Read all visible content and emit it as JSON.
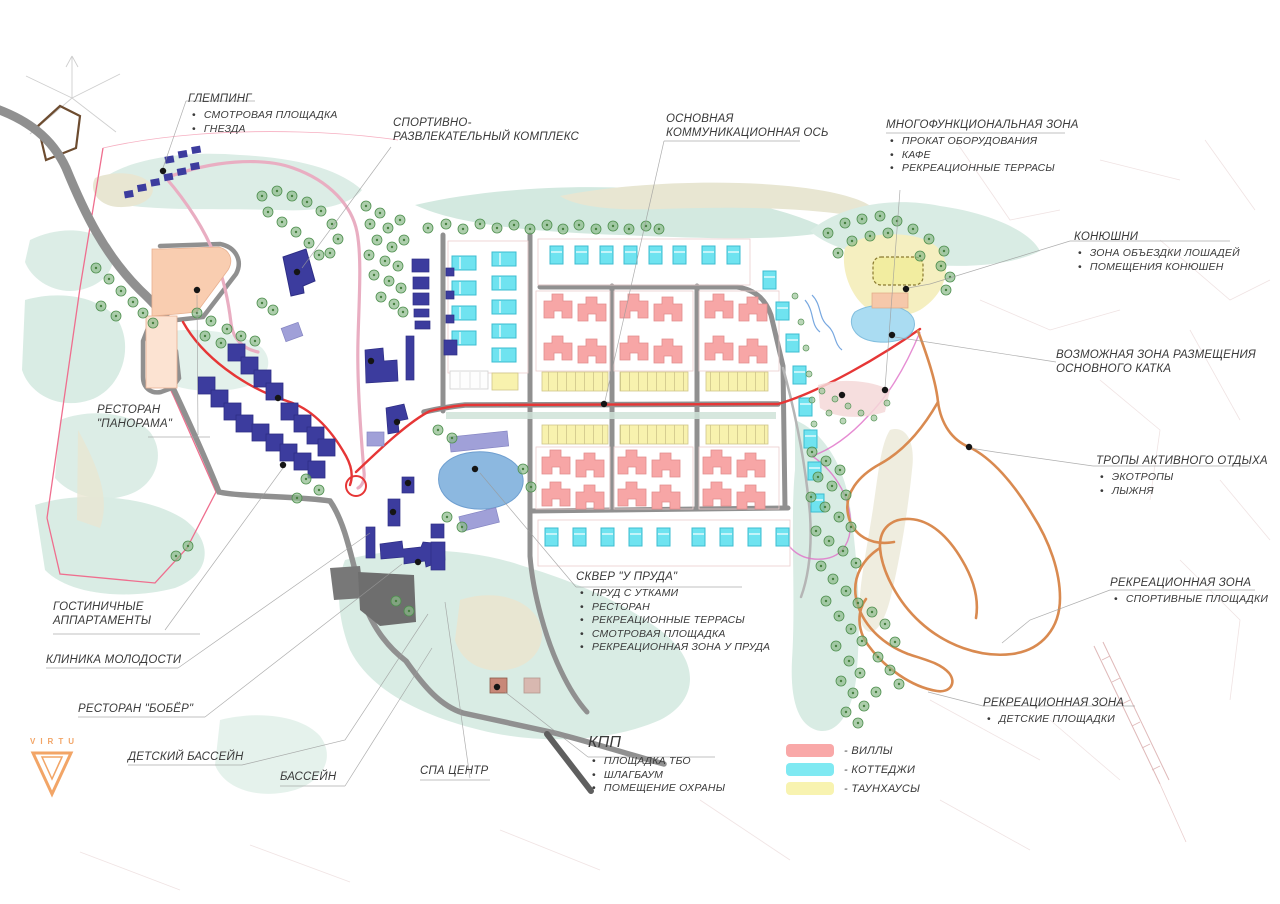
{
  "callouts": {
    "glamping": {
      "title": "ГЛЕМПИНГ",
      "items": [
        "СМОТРОВАЯ ПЛОЩАДКА",
        "ГНЕЗДА"
      ]
    },
    "sports": {
      "title": "СПОРТИВНО-РАЗВЛЕКАТЕЛЬНЫЙ КОМПЛЕКС"
    },
    "axis": {
      "title": "ОСНОВНАЯ КОММУНИКАЦИОННАЯ ОСЬ"
    },
    "multizone": {
      "title": "МНОГОФУНКЦИОНАЛЬНАЯ ЗОНА",
      "items": [
        "ПРОКАТ ОБОРУДОВАНИЯ",
        "КАФЕ",
        "РЕКРЕАЦИОННЫЕ ТЕРРАСЫ"
      ]
    },
    "stables": {
      "title": "КОНЮШНИ",
      "items": [
        "ЗОНА ОБЪЕЗДКИ ЛОШАДЕЙ",
        "ПОМЕЩЕНИЯ КОНЮШЕН"
      ]
    },
    "rink": {
      "title": "ВОЗМОЖНАЯ ЗОНА РАЗМЕЩЕНИЯ ОСНОВНОГО КАТКА"
    },
    "trails": {
      "title": "ТРОПЫ АКТИВНОГО ОТДЫХА",
      "items": [
        "ЭКОТРОПЫ",
        "ЛЫЖНЯ"
      ]
    },
    "rec_sport": {
      "title": "РЕКРЕАЦИОННАЯ ЗОНА",
      "items": [
        "СПОРТИВНЫЕ ПЛОЩАДКИ"
      ]
    },
    "rec_kids": {
      "title": "РЕКРЕАЦИОННАЯ ЗОНА",
      "items": [
        "ДЕТСКИЕ ПЛОЩАДКИ"
      ]
    },
    "panorama": {
      "title": "РЕСТОРАН \"ПАНОРАМА\""
    },
    "apartments": {
      "title": "ГОСТИНИЧНЫЕ АППАРТАМЕНТЫ"
    },
    "clinic": {
      "title": "КЛИНИКА МОЛОДОСТИ"
    },
    "beaver": {
      "title": "РЕСТОРАН \"БОБЁР\""
    },
    "kids_pool": {
      "title": "ДЕТСКИЙ БАССЕЙН"
    },
    "pool": {
      "title": "БАССЕЙН"
    },
    "spa": {
      "title": "СПА ЦЕНТР"
    },
    "kpp": {
      "title": "КПП",
      "items": [
        "ПЛОЩАДКА ТБО",
        "ШЛАГБАУМ",
        "ПОМЕЩЕНИЕ ОХРАНЫ"
      ]
    },
    "pond_square": {
      "title": "СКВЕР \"У ПРУДА\"",
      "items": [
        "ПРУД С УТКАМИ",
        "РЕСТОРАН",
        "РЕКРЕАЦИОННЫЕ ТЕРРАСЫ",
        "СМОТРОВАЯ ПЛОЩАДКА",
        "РЕКРЕАЦИОННАЯ ЗОНА У ПРУДА"
      ]
    }
  },
  "legend": {
    "items": [
      {
        "label": "- ВИЛЛЫ",
        "color": "#f9a8a8"
      },
      {
        "label": "- КОТТЕДЖИ",
        "color": "#7fe9f2"
      },
      {
        "label": "- ТАУНХАУСЫ",
        "color": "#f8f3b0"
      }
    ]
  },
  "logo": {
    "brand": "VIRTU",
    "color": "#f2a567"
  },
  "map": {
    "colors": {
      "villas": "#f7a6a6",
      "cottages": "#6fe3f0",
      "townhouses": "#f8f2ae",
      "apartment_blocks_navy": "#3c3c9e",
      "roads_gray": "#909090",
      "main_axis_red": "#e63636",
      "activity_trails_orange": "#d98a50",
      "site_boundary_pink": "#ef6e8e",
      "water_blue": "#8cb8e0",
      "greenery_mint": "#dcede6"
    }
  }
}
